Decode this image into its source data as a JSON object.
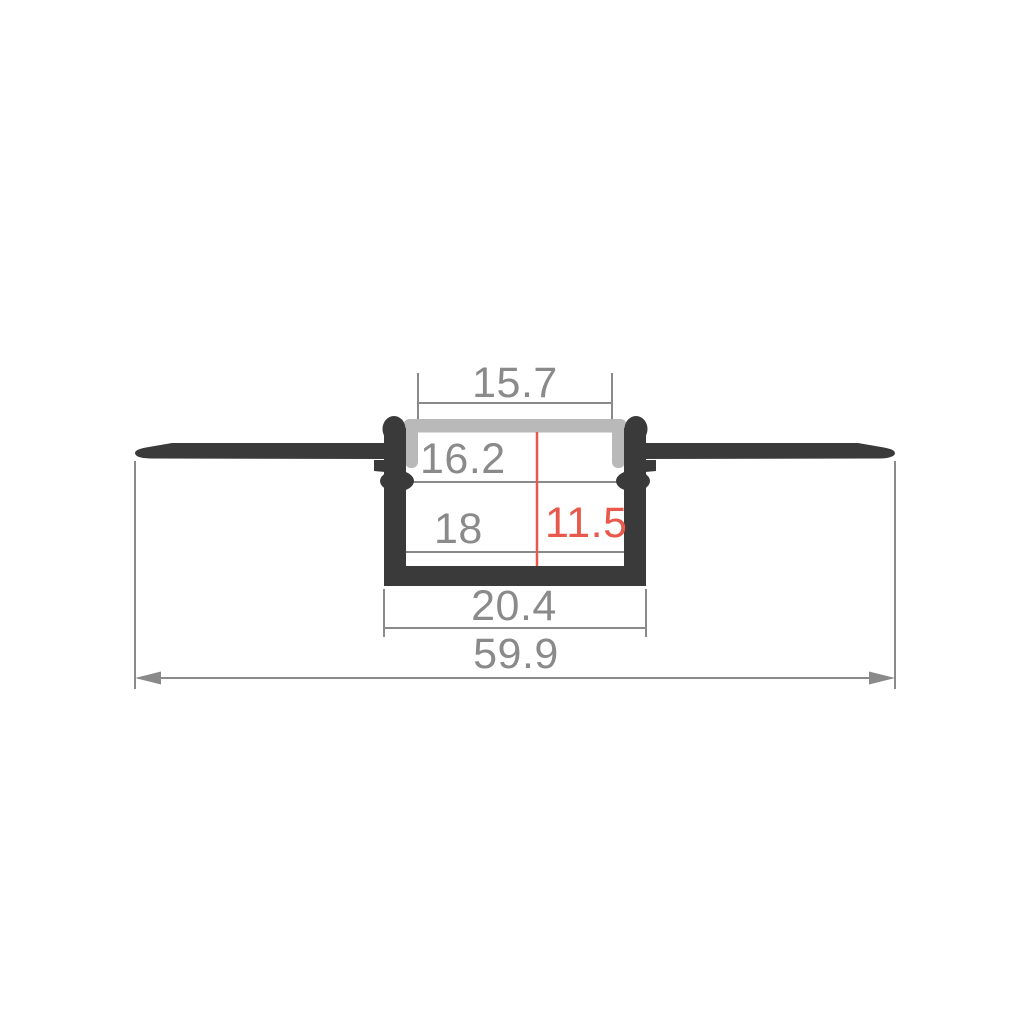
{
  "page": {
    "background": "#ffffff"
  },
  "diagram": {
    "subject": "recessed-led-profile-cross-section",
    "colors": {
      "profile_body": "#3a3a3a",
      "diffuser_cover": "#b9b9b9",
      "dimension_lines": "#8a8a8a",
      "accent_red": "#e8584c"
    },
    "dimensions": {
      "diffuser_opening_width": "15.7",
      "recess_top_width": "16.2",
      "inner_width": "18",
      "inner_height": "11.5",
      "body_outer_width": "20.4",
      "overall_width": "59.9"
    }
  }
}
